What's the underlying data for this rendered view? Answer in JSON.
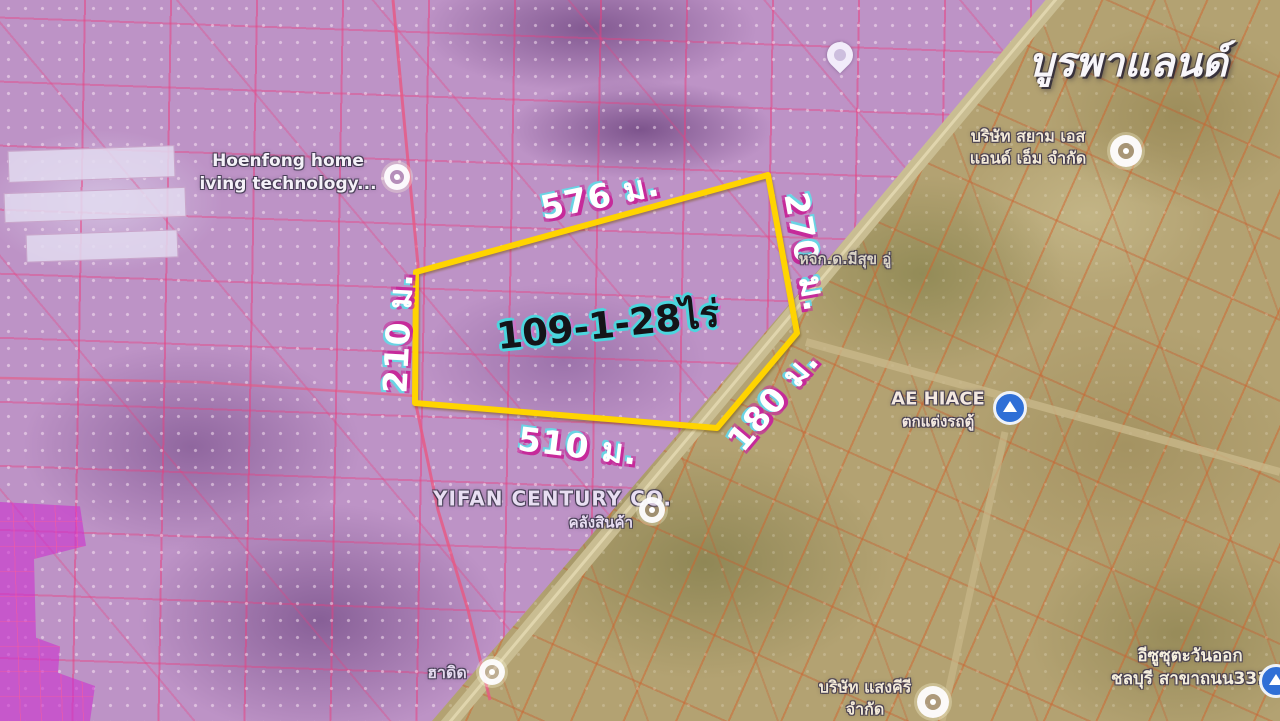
{
  "watermark": "บูรพาแลนด์",
  "plot": {
    "area_label": "109-1-28ไร่",
    "outline_points": "416,272 768,175 797,333 717,428 415,403",
    "dimensions": {
      "top": "576 ม.",
      "right": "270 ม.",
      "left": "210 ม.",
      "bottom": "510 ม.",
      "diagonal": "180 ม."
    }
  },
  "pois": {
    "hoenfong": {
      "line1": "Hoenfong home",
      "line2": "iving technology..."
    },
    "siam_sm": {
      "line1": "บริษัท สยาม เอส",
      "line2": "แอนด์ เอ็ม จำกัด"
    },
    "meesuk": {
      "line1": "หจก.ด.มีสุข อู่"
    },
    "ae_hiace": {
      "line1": "AE HIACE",
      "line2": "ตกแต่งรถตู้"
    },
    "yifan": {
      "line1": "YIFAN CENTURY CO.",
      "line2": "คลังสินค้า"
    },
    "hadid": {
      "line1": "ฮาดิด"
    },
    "saengkhiri": {
      "line1": "บริษัท แสงคีรี",
      "line2": "จำกัด"
    },
    "isuzu": {
      "line1": "อีซูซุตะวันออก",
      "line2": "ชลบุรี สาขาถนน331"
    }
  },
  "colors": {
    "plot_outline": "#ffd400",
    "overlay_purple": "#bd93c6",
    "overlay_magenta": "#cc34ce",
    "parcel_line_pink": "#eb3c7d",
    "parcel_line_orange": "#d0642d",
    "terrain_tan": "#b3a272",
    "dimension_text": "#ffffff",
    "dimension_shadow_magenta": "#c62a9a",
    "dimension_shadow_cyan": "#6ad4e4",
    "area_text": "#141418",
    "area_outline": "#4cd6de",
    "poi_icon_blue": "#2f6fd6"
  }
}
